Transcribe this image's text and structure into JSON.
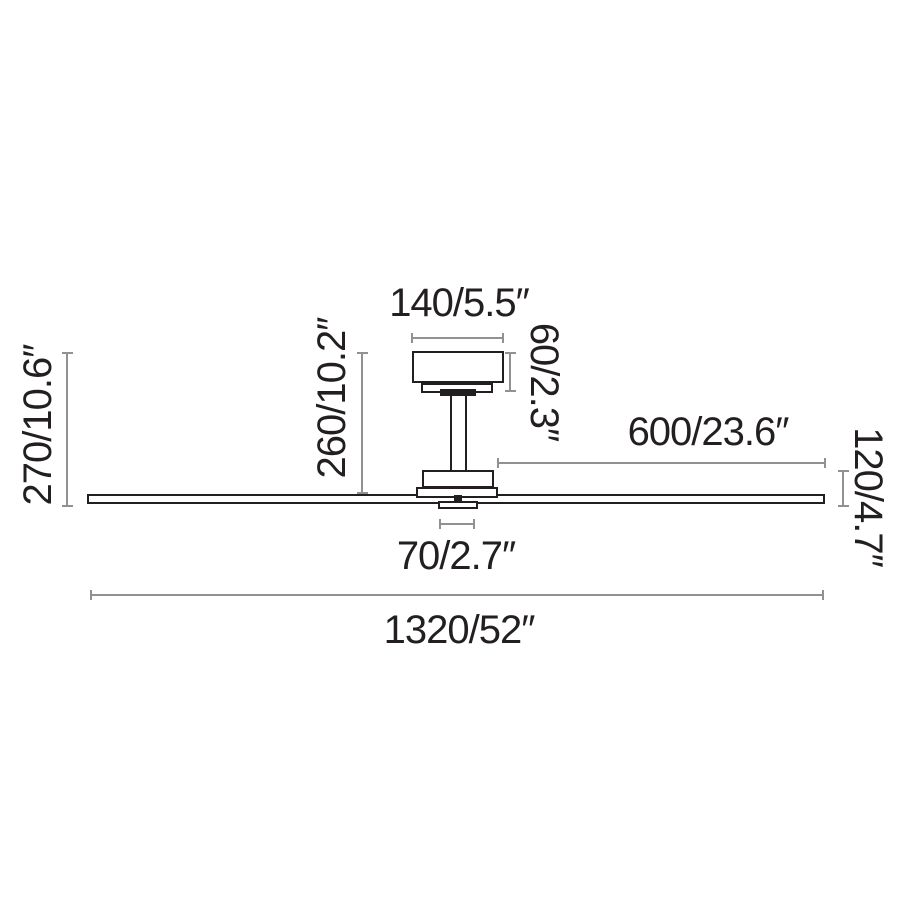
{
  "colors": {
    "outline": "#231f20",
    "dimension_lines": "#8f9194",
    "background": "#ffffff"
  },
  "dims": {
    "canopy_width": "140/5.5″",
    "canopy_height": "60/2.3″",
    "canopy_to_blade_drop": "260/10.2″",
    "total_drop": "270/10.6″",
    "blade_length": "600/23.6″",
    "body_height": "120/4.7″",
    "hub_width": "70/2.7″",
    "sweep_diameter": "1320/52″"
  }
}
